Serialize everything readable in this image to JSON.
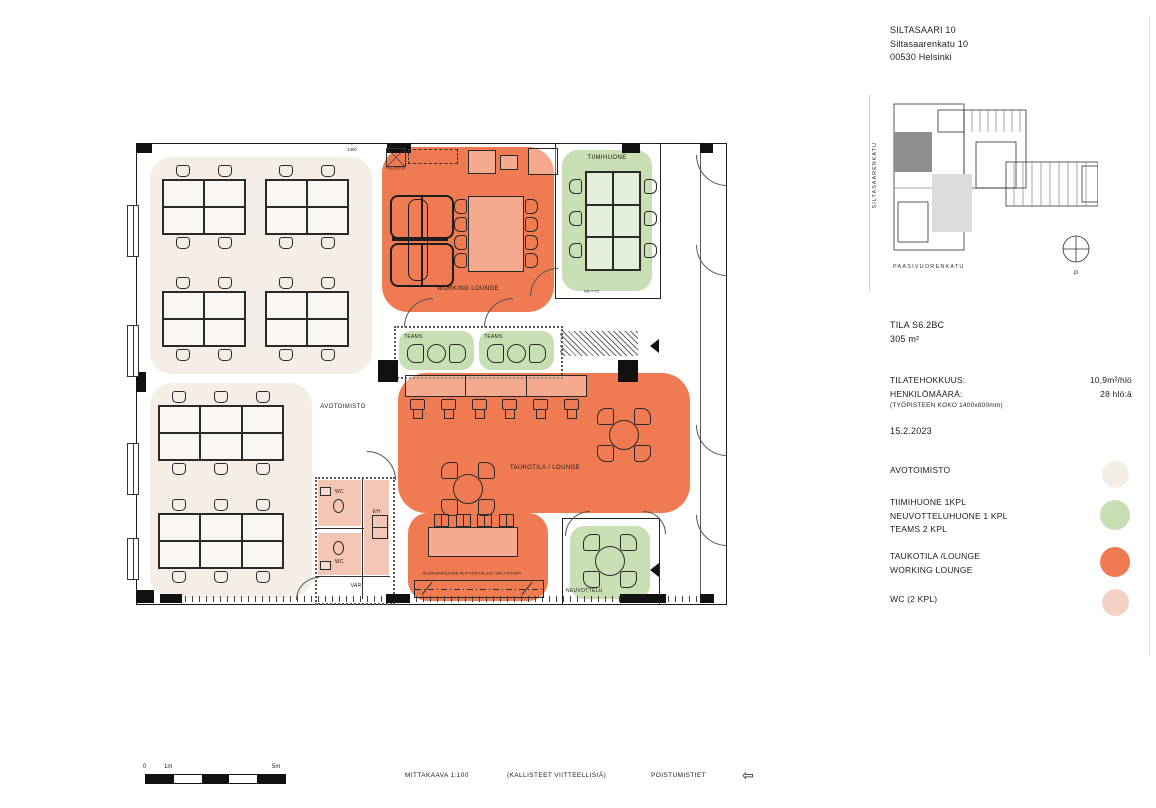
{
  "header": {
    "building": "SILTASAARI 10",
    "address": "Siltasaarenkatu 10",
    "city": "00530 Helsinki"
  },
  "site_plan": {
    "street_left": "SILTASAARENKATU",
    "street_bottom": "PAASIVUORENKATU",
    "north_label": "P"
  },
  "space_info": {
    "space_id": "TILA S6.2BC",
    "area": "305 m²",
    "efficiency_label": "TILATEHOKKUUS:",
    "efficiency_value": "10,9m²/hlö",
    "headcount_label": "HENKILÖMÄÄRÄ:",
    "headcount_value": "28 hlö:ä",
    "workstation_note": "(TYÖPISTEEN KOKO 1400x800mm)",
    "date": "15.2.2023"
  },
  "legend": {
    "items": [
      {
        "lines": [
          "AVOTOIMISTO"
        ],
        "color": "#f5eee7"
      },
      {
        "lines": [
          "TIIMIHUONE 1KPL",
          "NEUVOTTELUHUONE 1 KPL",
          "TEAMS 2 KPL"
        ],
        "color": "#c8dfb4"
      },
      {
        "lines": [
          "TAUKOTILA /LOUNGE",
          "WORKING LOUNGE"
        ],
        "color": "#f07b52"
      },
      {
        "lines": [
          "WC (2 KPL)"
        ],
        "color": "#f6d1c6"
      }
    ]
  },
  "plan_labels": {
    "avotoimisto": "AVOTOIMISTO",
    "working_lounge": "WORKING LOUNGE",
    "tiimihuone": "TIIMIHUONE",
    "teams_1": "TEAMS",
    "teams_2": "TEAMS",
    "taukotila": "TAUKOTILA / LOUNGE",
    "neuvottelu": "NEUVOTTELU",
    "wc_1": "WC",
    "wc_2": "WC",
    "eh": "EH",
    "var": "VAR",
    "naytto": "NÄYTTÖ",
    "tulostin": "TULOSTIN",
    "kitchen_note": "OLEMASSAOLEVAN KEITTIÖN KALUST. SÄILYTETÄÄN",
    "level_mark": "1300"
  },
  "footer": {
    "scale_0": "0",
    "scale_1": "1m",
    "scale_5": "5m",
    "scale_label": "MITTAKAAVA 1:100",
    "slope_note": "(KALLISTEET VIITTEELLISIÄ)",
    "exits_label": "POISTUMISTIET"
  },
  "icons": {
    "up_arrow": "↑",
    "exit_arrow": "⇦"
  },
  "colors": {
    "open_office": "#f5eee7",
    "meeting": "#c8dfb4",
    "lounge": "#f07b52",
    "wc": "#f4c6b5",
    "site_highlight": "#8f8f8f",
    "site_light": "#dcdcdc"
  }
}
